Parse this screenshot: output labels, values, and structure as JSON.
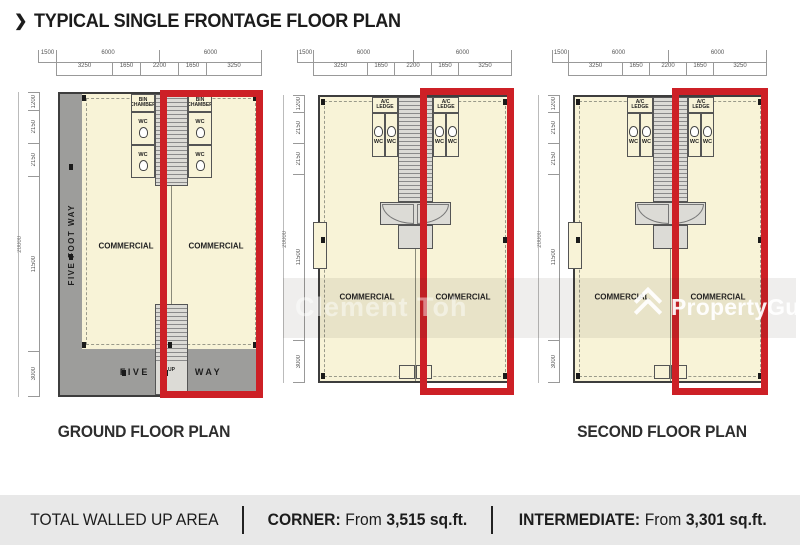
{
  "title": {
    "arrow": "❯",
    "text": "TYPICAL SINGLE FRONTAGE FLOOR PLAN"
  },
  "dims": {
    "top": [
      "1500",
      "6000",
      "6000"
    ],
    "sub": [
      "3250",
      "1650",
      "2200",
      "1650",
      "3250"
    ],
    "left": [
      "1200",
      "2150",
      "2150",
      "11500",
      "3000"
    ],
    "total": "20000"
  },
  "plans": [
    {
      "label": "GROUND FLOOR PLAN",
      "commercial": "COMMERCIAL",
      "wc": "WC",
      "bin_chamber": "BIN CHAMBER",
      "five_foot_way": "FIVE FOOT WAY",
      "up": "UP"
    },
    {
      "label": "",
      "commercial": "COMMERCIAL",
      "wc": "WC",
      "ac_ledge": "A/C LEDGE"
    },
    {
      "label": "SECOND FLOOR PLAN",
      "commercial": "COMMERCIAL",
      "wc": "WC",
      "ac_ledge": "A/C LEDGE"
    }
  ],
  "watermarks": {
    "agent": "Clement Toh",
    "brand": "PropertyGuru"
  },
  "footer": {
    "area_label": "TOTAL WALLED UP AREA",
    "corner_label": "CORNER:",
    "corner_from": "From",
    "corner_value": "3,515 sq.ft.",
    "intermediate_label": "INTERMEDIATE:",
    "intermediate_from": "From",
    "intermediate_value": "3,301 sq.ft."
  },
  "colors": {
    "red": "#cd2026",
    "floor": "#f8f3d7",
    "walkway": "#9d9d9b",
    "core": "#dcdbd6",
    "footer_bg": "#e8e8e8"
  }
}
